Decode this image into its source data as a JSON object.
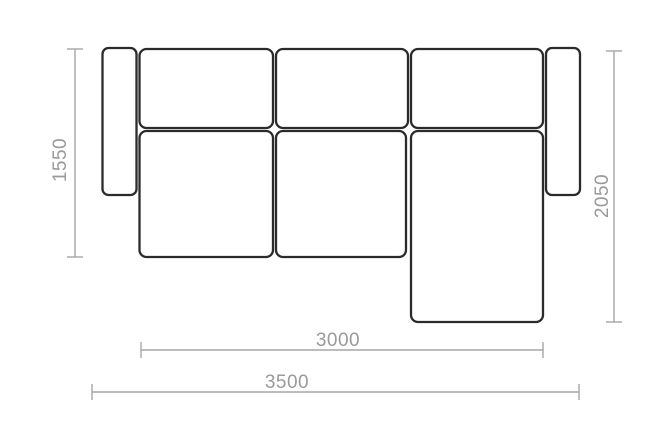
{
  "diagram": {
    "kind": "sofa-floor-plan-with-dimensions",
    "dimension_labels": {
      "sofa_depth": "1550",
      "chaise_depth": "2050",
      "seat_width": "3000",
      "overall_width": "3500"
    },
    "colors": {
      "outline": "#2b2b2b",
      "dimension_line": "#a6a6a6",
      "dimension_text": "#9a9a9a",
      "background": "#ffffff"
    },
    "parts": [
      "left-armrest",
      "back-cushion-1",
      "back-cushion-2",
      "back-cushion-3",
      "seat-cushion-1",
      "seat-cushion-2",
      "chaise-seat",
      "right-armrest"
    ]
  }
}
